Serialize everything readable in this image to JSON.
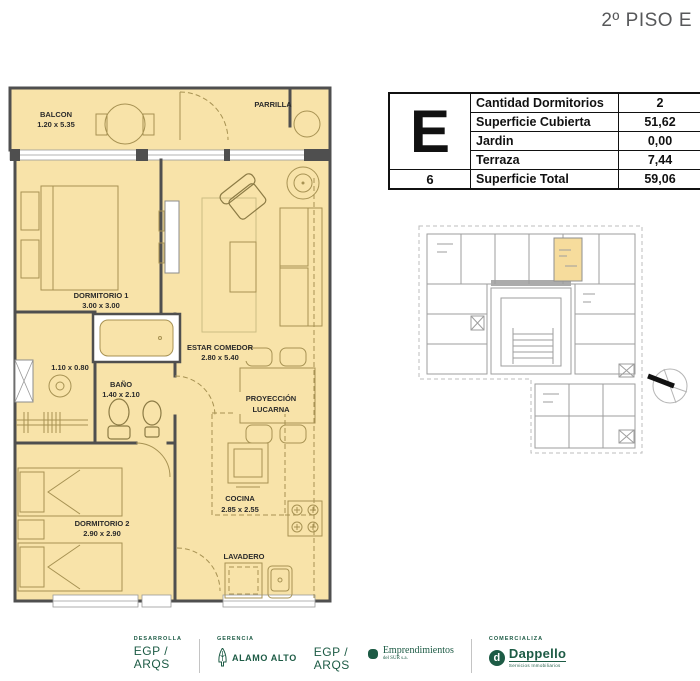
{
  "title": "2º PISO E",
  "unit_table": {
    "unit_letter": "E",
    "unit_number": "6",
    "rows": [
      {
        "label": "Cantidad Dormitorios",
        "value": "2"
      },
      {
        "label": "Superficie Cubierta",
        "value": "51,62"
      },
      {
        "label": "Jardin",
        "value": "0,00"
      },
      {
        "label": "Terraza",
        "value": "7,44"
      },
      {
        "label": "Superficie Total",
        "value": "59,06"
      }
    ]
  },
  "floor_plan": {
    "balcony": {
      "name": "BALCON",
      "dims": "1.20 x 5.35"
    },
    "parrilla": {
      "name": "PARRILLA"
    },
    "dormitorio1": {
      "name": "DORMITORIO 1",
      "dims": "3.00 x 3.00"
    },
    "vanity_dims": "1.10 x 0.80",
    "bano": {
      "name": "BAÑO",
      "dims": "1.40 x 2.10"
    },
    "dormitorio2": {
      "name": "DORMITORIO 2",
      "dims": "2.90 x 2.90"
    },
    "estar": {
      "name": "ESTAR COMEDOR",
      "dims": "2.80 x 5.40"
    },
    "proyeccion": {
      "line1": "PROYECCIÓN",
      "line2": "LUCARNA"
    },
    "cocina": {
      "name": "COCINA",
      "dims": "2.85 x 2.55"
    },
    "lavadero": {
      "name": "LAVADERO"
    }
  },
  "key_plan": {
    "highlighted_unit": "E"
  },
  "footer": {
    "developer": {
      "label": "DESARROLLA",
      "line1": "EGP /",
      "line2": "ARQS"
    },
    "management": {
      "label": "GERENCIA",
      "brand": "ALAMO ALTO"
    },
    "architects": {
      "line1": "EGP /",
      "line2": "ARQS"
    },
    "emprendimientos": {
      "line1": "Emprendimientos",
      "line2": "del SUR s.a."
    },
    "marketer": {
      "label": "COMERCIALIZA",
      "brand": "Dappello",
      "tagline": "Servicios Inmobiliarios",
      "icon_letter": "d"
    }
  },
  "colors": {
    "plan_fill": "#f8e3a9",
    "wall": "#4f4f4f",
    "furniture_line": "#a79253",
    "key_plan_highlight": "#f6dc9c",
    "logo_green": "#1d5b45",
    "title_gray": "#57585a"
  }
}
